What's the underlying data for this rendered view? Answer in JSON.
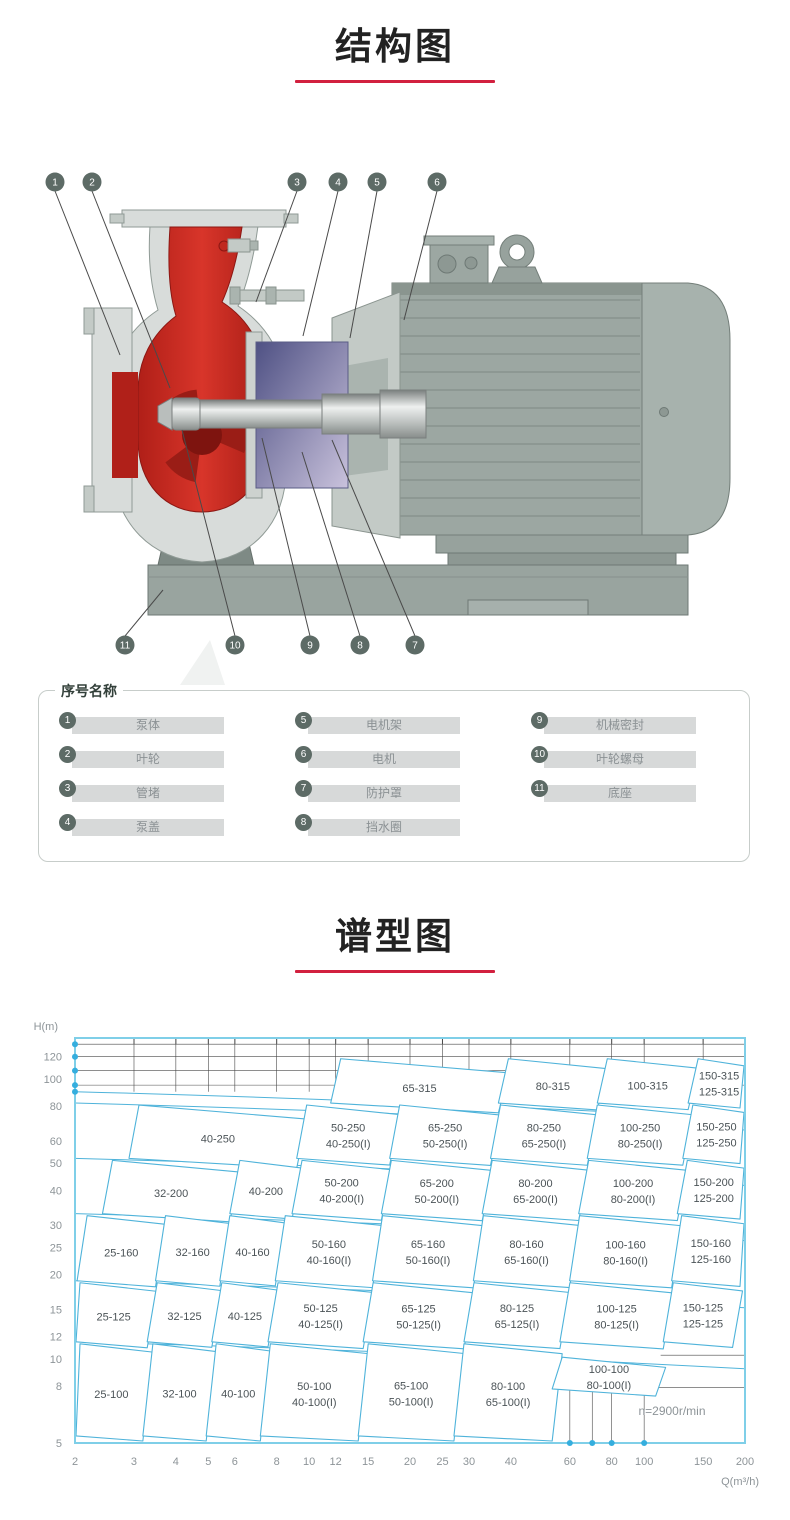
{
  "sections": {
    "structure_title": "结构图",
    "spectrum_title": "谱型图"
  },
  "legend": {
    "title": "序号名称",
    "items": [
      {
        "no": "1",
        "name": "泵体"
      },
      {
        "no": "2",
        "name": "叶轮"
      },
      {
        "no": "3",
        "name": "管堵"
      },
      {
        "no": "4",
        "name": "泵盖"
      },
      {
        "no": "5",
        "name": "电机架"
      },
      {
        "no": "6",
        "name": "电机"
      },
      {
        "no": "7",
        "name": "防护罩"
      },
      {
        "no": "8",
        "name": "挡水圈"
      },
      {
        "no": "9",
        "name": "机械密封"
      },
      {
        "no": "10",
        "name": "叶轮螺母"
      },
      {
        "no": "11",
        "name": "底座"
      }
    ]
  },
  "diagram": {
    "callouts": [
      "1",
      "2",
      "3",
      "4",
      "5",
      "6",
      "7",
      "8",
      "9",
      "10",
      "11"
    ]
  },
  "chart_data": {
    "type": "region-map",
    "title": "谱型图",
    "xlabel": "Q(m³/h)",
    "ylabel": "H(m)",
    "x_scale": "log",
    "y_scale": "log",
    "x_range": [
      2,
      200
    ],
    "y_range": [
      5,
      140
    ],
    "x_ticks": [
      2,
      3,
      4,
      5,
      6,
      8,
      10,
      12,
      15,
      20,
      25,
      30,
      40,
      60,
      80,
      100,
      150,
      200
    ],
    "y_ticks": [
      120,
      100,
      80,
      60,
      50,
      40,
      30,
      25,
      20,
      15,
      12,
      10,
      8,
      5
    ],
    "annotation": "n=2900r/min",
    "grid_h_top": [
      95,
      107,
      120,
      133
    ],
    "sweep_curves": [
      90,
      82,
      52,
      33,
      19,
      11.5
    ],
    "axis_dots_left_h": [
      90,
      95,
      107,
      120,
      133
    ],
    "axis_dots_bottom_q": [
      60,
      70,
      80,
      100
    ],
    "br_grid": {
      "v": [
        {
          "q": 60,
          "h1": 5,
          "h2": 7.9
        },
        {
          "q": 70,
          "h1": 5,
          "h2": 7.9
        },
        {
          "q": 80,
          "h1": 5,
          "h2": 7.9
        },
        {
          "q": 100,
          "h1": 5,
          "h2": 7.9
        }
      ],
      "h": [
        {
          "h": 10.3,
          "q1": 112,
          "q2": 200
        },
        {
          "h": 7.9,
          "q1": 55,
          "q2": 200
        }
      ]
    },
    "rows": [
      {
        "h": [
          82,
          120
        ],
        "cells": [
          {
            "labels": [
              "65-315"
            ],
            "q": [
              12,
              38
            ]
          },
          {
            "labels": [
              "80-315"
            ],
            "q": [
              38,
              75
            ]
          },
          {
            "labels": [
              "100-315"
            ],
            "q": [
              75,
              140
            ]
          },
          {
            "labels": [
              "150-315",
              "125-315"
            ],
            "q": [
              140,
              200
            ]
          }
        ]
      },
      {
        "h": [
          52,
          82
        ],
        "cells": [
          {
            "labels": [
              "40-250"
            ],
            "q": [
              3,
              9.5
            ]
          },
          {
            "labels": [
              "50-250",
              "40-250(I)"
            ],
            "q": [
              9.5,
              18
            ]
          },
          {
            "labels": [
              "65-250",
              "50-250(I)"
            ],
            "q": [
              18,
              36
            ]
          },
          {
            "labels": [
              "80-250",
              "65-250(I)"
            ],
            "q": [
              36,
              70
            ]
          },
          {
            "labels": [
              "100-250",
              "80-250(I)"
            ],
            "q": [
              70,
              135
            ]
          },
          {
            "labels": [
              "150-250",
              "125-250"
            ],
            "q": [
              135,
              200
            ]
          }
        ]
      },
      {
        "h": [
          33,
          52
        ],
        "cells": [
          {
            "labels": [
              "32-200"
            ],
            "q": [
              2.5,
              6
            ]
          },
          {
            "labels": [
              "40-200"
            ],
            "q": [
              6,
              9.2
            ]
          },
          {
            "labels": [
              "50-200",
              "40-200(I)"
            ],
            "q": [
              9.2,
              17
            ]
          },
          {
            "labels": [
              "65-200",
              "50-200(I)"
            ],
            "q": [
              17,
              34
            ]
          },
          {
            "labels": [
              "80-200",
              "65-200(I)"
            ],
            "q": [
              34,
              66
            ]
          },
          {
            "labels": [
              "100-200",
              "80-200(I)"
            ],
            "q": [
              66,
              130
            ]
          },
          {
            "labels": [
              "150-200",
              "125-200"
            ],
            "q": [
              130,
              200
            ]
          }
        ]
      },
      {
        "h": [
          19,
          33
        ],
        "cells": [
          {
            "labels": [
              "25-160"
            ],
            "q": [
              2.1,
              3.6
            ]
          },
          {
            "labels": [
              "32-160"
            ],
            "q": [
              3.6,
              5.6
            ]
          },
          {
            "labels": [
              "40-160"
            ],
            "q": [
              5.6,
              8.2
            ]
          },
          {
            "labels": [
              "50-160",
              "40-160(I)"
            ],
            "q": [
              8.2,
              16
            ]
          },
          {
            "labels": [
              "65-160",
              "50-160(I)"
            ],
            "q": [
              16,
              32
            ]
          },
          {
            "labels": [
              "80-160",
              "65-160(I)"
            ],
            "q": [
              32,
              62
            ]
          },
          {
            "labels": [
              "100-160",
              "80-160(I)"
            ],
            "q": [
              62,
              125
            ]
          },
          {
            "labels": [
              "150-160",
              "125-160"
            ],
            "q": [
              125,
              200
            ]
          }
        ]
      },
      {
        "h": [
          11.5,
          19
        ],
        "cells": [
          {
            "labels": [
              "25-125"
            ],
            "q": [
              2,
              3.4
            ]
          },
          {
            "labels": [
              "32-125"
            ],
            "q": [
              3.4,
              5.3
            ]
          },
          {
            "labels": [
              "40-125"
            ],
            "q": [
              5.3,
              7.8
            ]
          },
          {
            "labels": [
              "50-125",
              "40-125(I)"
            ],
            "q": [
              7.8,
              15
            ]
          },
          {
            "labels": [
              "65-125",
              "50-125(I)"
            ],
            "q": [
              15,
              30
            ]
          },
          {
            "labels": [
              "80-125",
              "65-125(I)"
            ],
            "q": [
              30,
              58
            ]
          },
          {
            "labels": [
              "100-125",
              "80-125(I)"
            ],
            "q": [
              58,
              118
            ]
          },
          {
            "labels": [
              "150-125",
              "125-125"
            ],
            "q": [
              118,
              190
            ]
          }
        ]
      },
      {
        "h": [
          5.3,
          11.5
        ],
        "cells": [
          {
            "labels": [
              "25-100"
            ],
            "q": [
              2,
              3.3
            ]
          },
          {
            "labels": [
              "32-100"
            ],
            "q": [
              3.3,
              5.1
            ]
          },
          {
            "labels": [
              "40-100"
            ],
            "q": [
              5.1,
              7.4
            ]
          },
          {
            "labels": [
              "50-100",
              "40-100(I)"
            ],
            "q": [
              7.4,
              14.5
            ]
          },
          {
            "labels": [
              "65-100",
              "50-100(I)"
            ],
            "q": [
              14.5,
              28
            ]
          },
          {
            "labels": [
              "80-100",
              "65-100(I)"
            ],
            "q": [
              28,
              55
            ]
          },
          {
            "labels": [
              "100-100",
              "80-100(I)"
            ],
            "q": [
              55,
              112
            ],
            "h": [
              7.8,
              10.3
            ]
          }
        ]
      }
    ],
    "colors": {
      "tile_stroke": "#4fb3da",
      "frame": "#7fcfe8",
      "grid": "#4a4a4a",
      "tick_text": "#8d9498",
      "tile_text": "#4b5357",
      "dot": "#35aede",
      "accent_red": "#d2203f"
    }
  }
}
